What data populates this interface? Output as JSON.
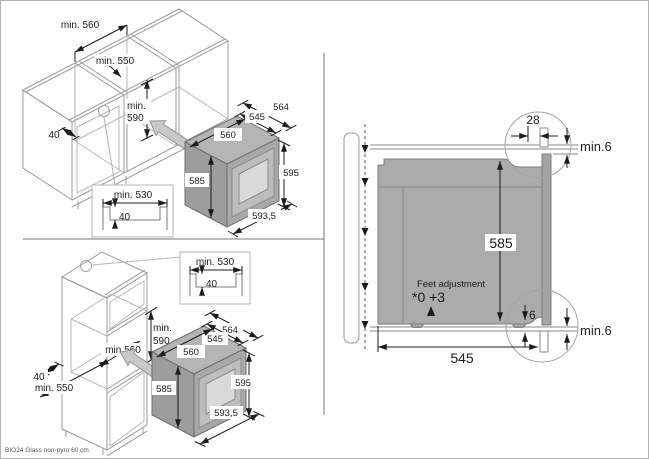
{
  "footer": {
    "note": "BIO24 Glass non-pyro 60 cm"
  },
  "base_cabinet_view": {
    "niche_width": "min. 560",
    "niche_depth": "min. 550",
    "niche_height_l1": "min.",
    "niche_height_l2": "590",
    "front_rail": "40",
    "detail": {
      "recess_width": "min. 530",
      "recess_depth": "40"
    },
    "oven": {
      "total_depth": "564",
      "body_depth": "545",
      "width": "560",
      "height_side": "585",
      "height_front": "595",
      "width_front": "593,5"
    }
  },
  "tall_cabinet_view": {
    "niche_width": "min.560",
    "niche_depth": "min. 550",
    "niche_height_l1": "min.",
    "niche_height_l2": "590",
    "front_rail": "40",
    "detail": {
      "recess_width": "min. 530",
      "recess_depth": "40"
    },
    "oven": {
      "total_depth": "564",
      "body_depth": "545",
      "width": "560",
      "height_side": "585",
      "height_front": "595",
      "width_front": "593,5"
    }
  },
  "side_view": {
    "front_overlap": "28",
    "top_clearance": "min.6",
    "oven_height": "585",
    "feet_label": "Feet adjustment",
    "feet_values": "*0 +3",
    "bottom_inset": "6",
    "bottom_clearance": "min.6",
    "oven_depth": "545"
  },
  "colors": {
    "oven_body": "#a9a9a9",
    "arrow_fill": "#c8c8c8",
    "line_gray": "#9b9b9b",
    "dim_black": "#1c1c1c"
  }
}
